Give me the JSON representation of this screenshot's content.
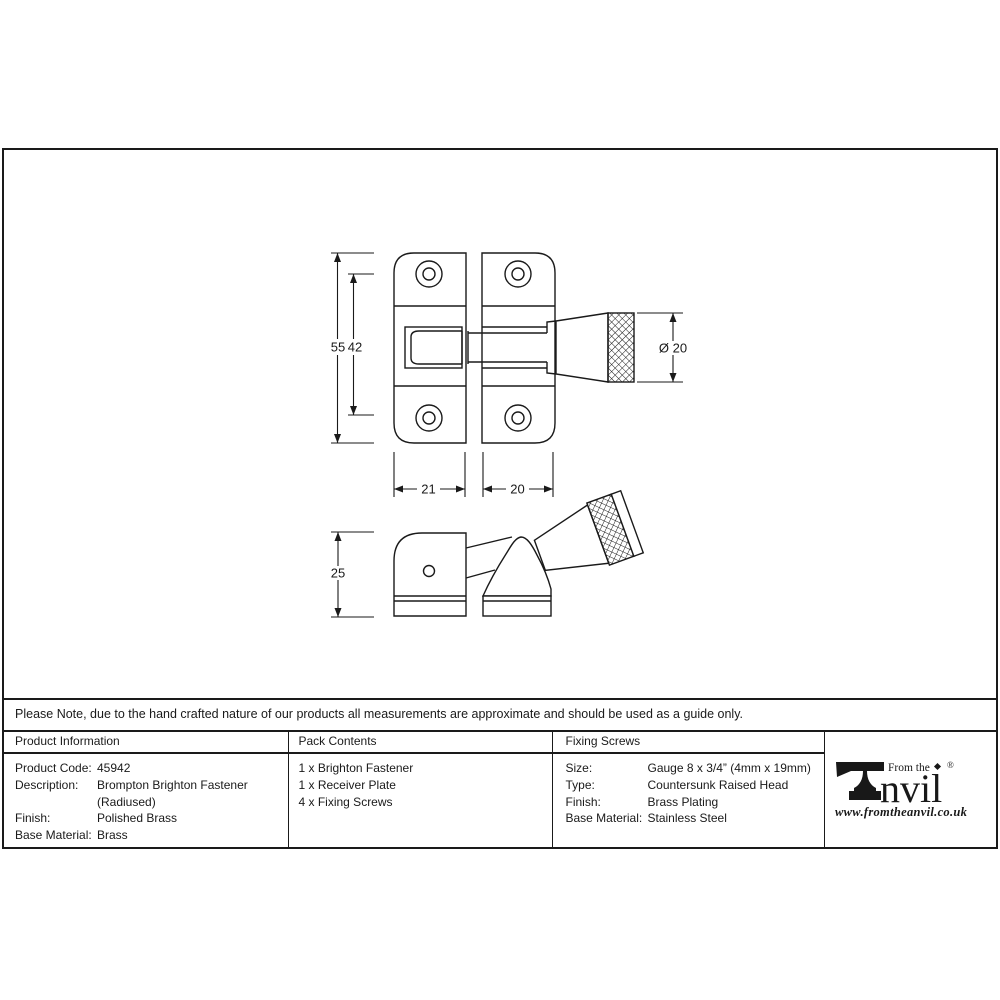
{
  "note": "Please Note, due to the hand crafted nature of our products all measurements are approximate and should be used as a guide only.",
  "drawing": {
    "front_view": {
      "dim_height_overall": "55",
      "dim_height_screws": "42",
      "dim_knob_diameter": "Ø 20",
      "dim_width_plate": "21",
      "dim_width_receiver": "20"
    },
    "side_view": {
      "dim_depth": "25"
    }
  },
  "table": {
    "product_information": {
      "header": "Product Information",
      "rows": [
        {
          "label": "Product Code:",
          "value": "45942"
        },
        {
          "label": "Description:",
          "value": "Brompton Brighton Fastener"
        },
        {
          "label": "",
          "value": "(Radiused)"
        },
        {
          "label": "Finish:",
          "value": "Polished Brass"
        },
        {
          "label": "Base Material:",
          "value": "Brass"
        }
      ]
    },
    "pack_contents": {
      "header": "Pack Contents",
      "items": [
        "1 x Brighton Fastener",
        "1 x Receiver Plate",
        "4 x Fixing Screws"
      ]
    },
    "fixing_screws": {
      "header": "Fixing Screws",
      "rows": [
        {
          "label": "Size:",
          "value": "Gauge 8 x 3/4” (4mm x 19mm)"
        },
        {
          "label": "Type:",
          "value": "Countersunk Raised Head"
        },
        {
          "label": "Finish:",
          "value": "Brass Plating"
        },
        {
          "label": "Base Material:",
          "value": "Stainless Steel"
        }
      ]
    }
  },
  "logo": {
    "from_the": "From the",
    "anvil_text": "nvil",
    "registered": "®",
    "website": "www.fromtheanvil.co.uk"
  },
  "colors": {
    "line": "#1a1a1a",
    "background": "#ffffff"
  }
}
